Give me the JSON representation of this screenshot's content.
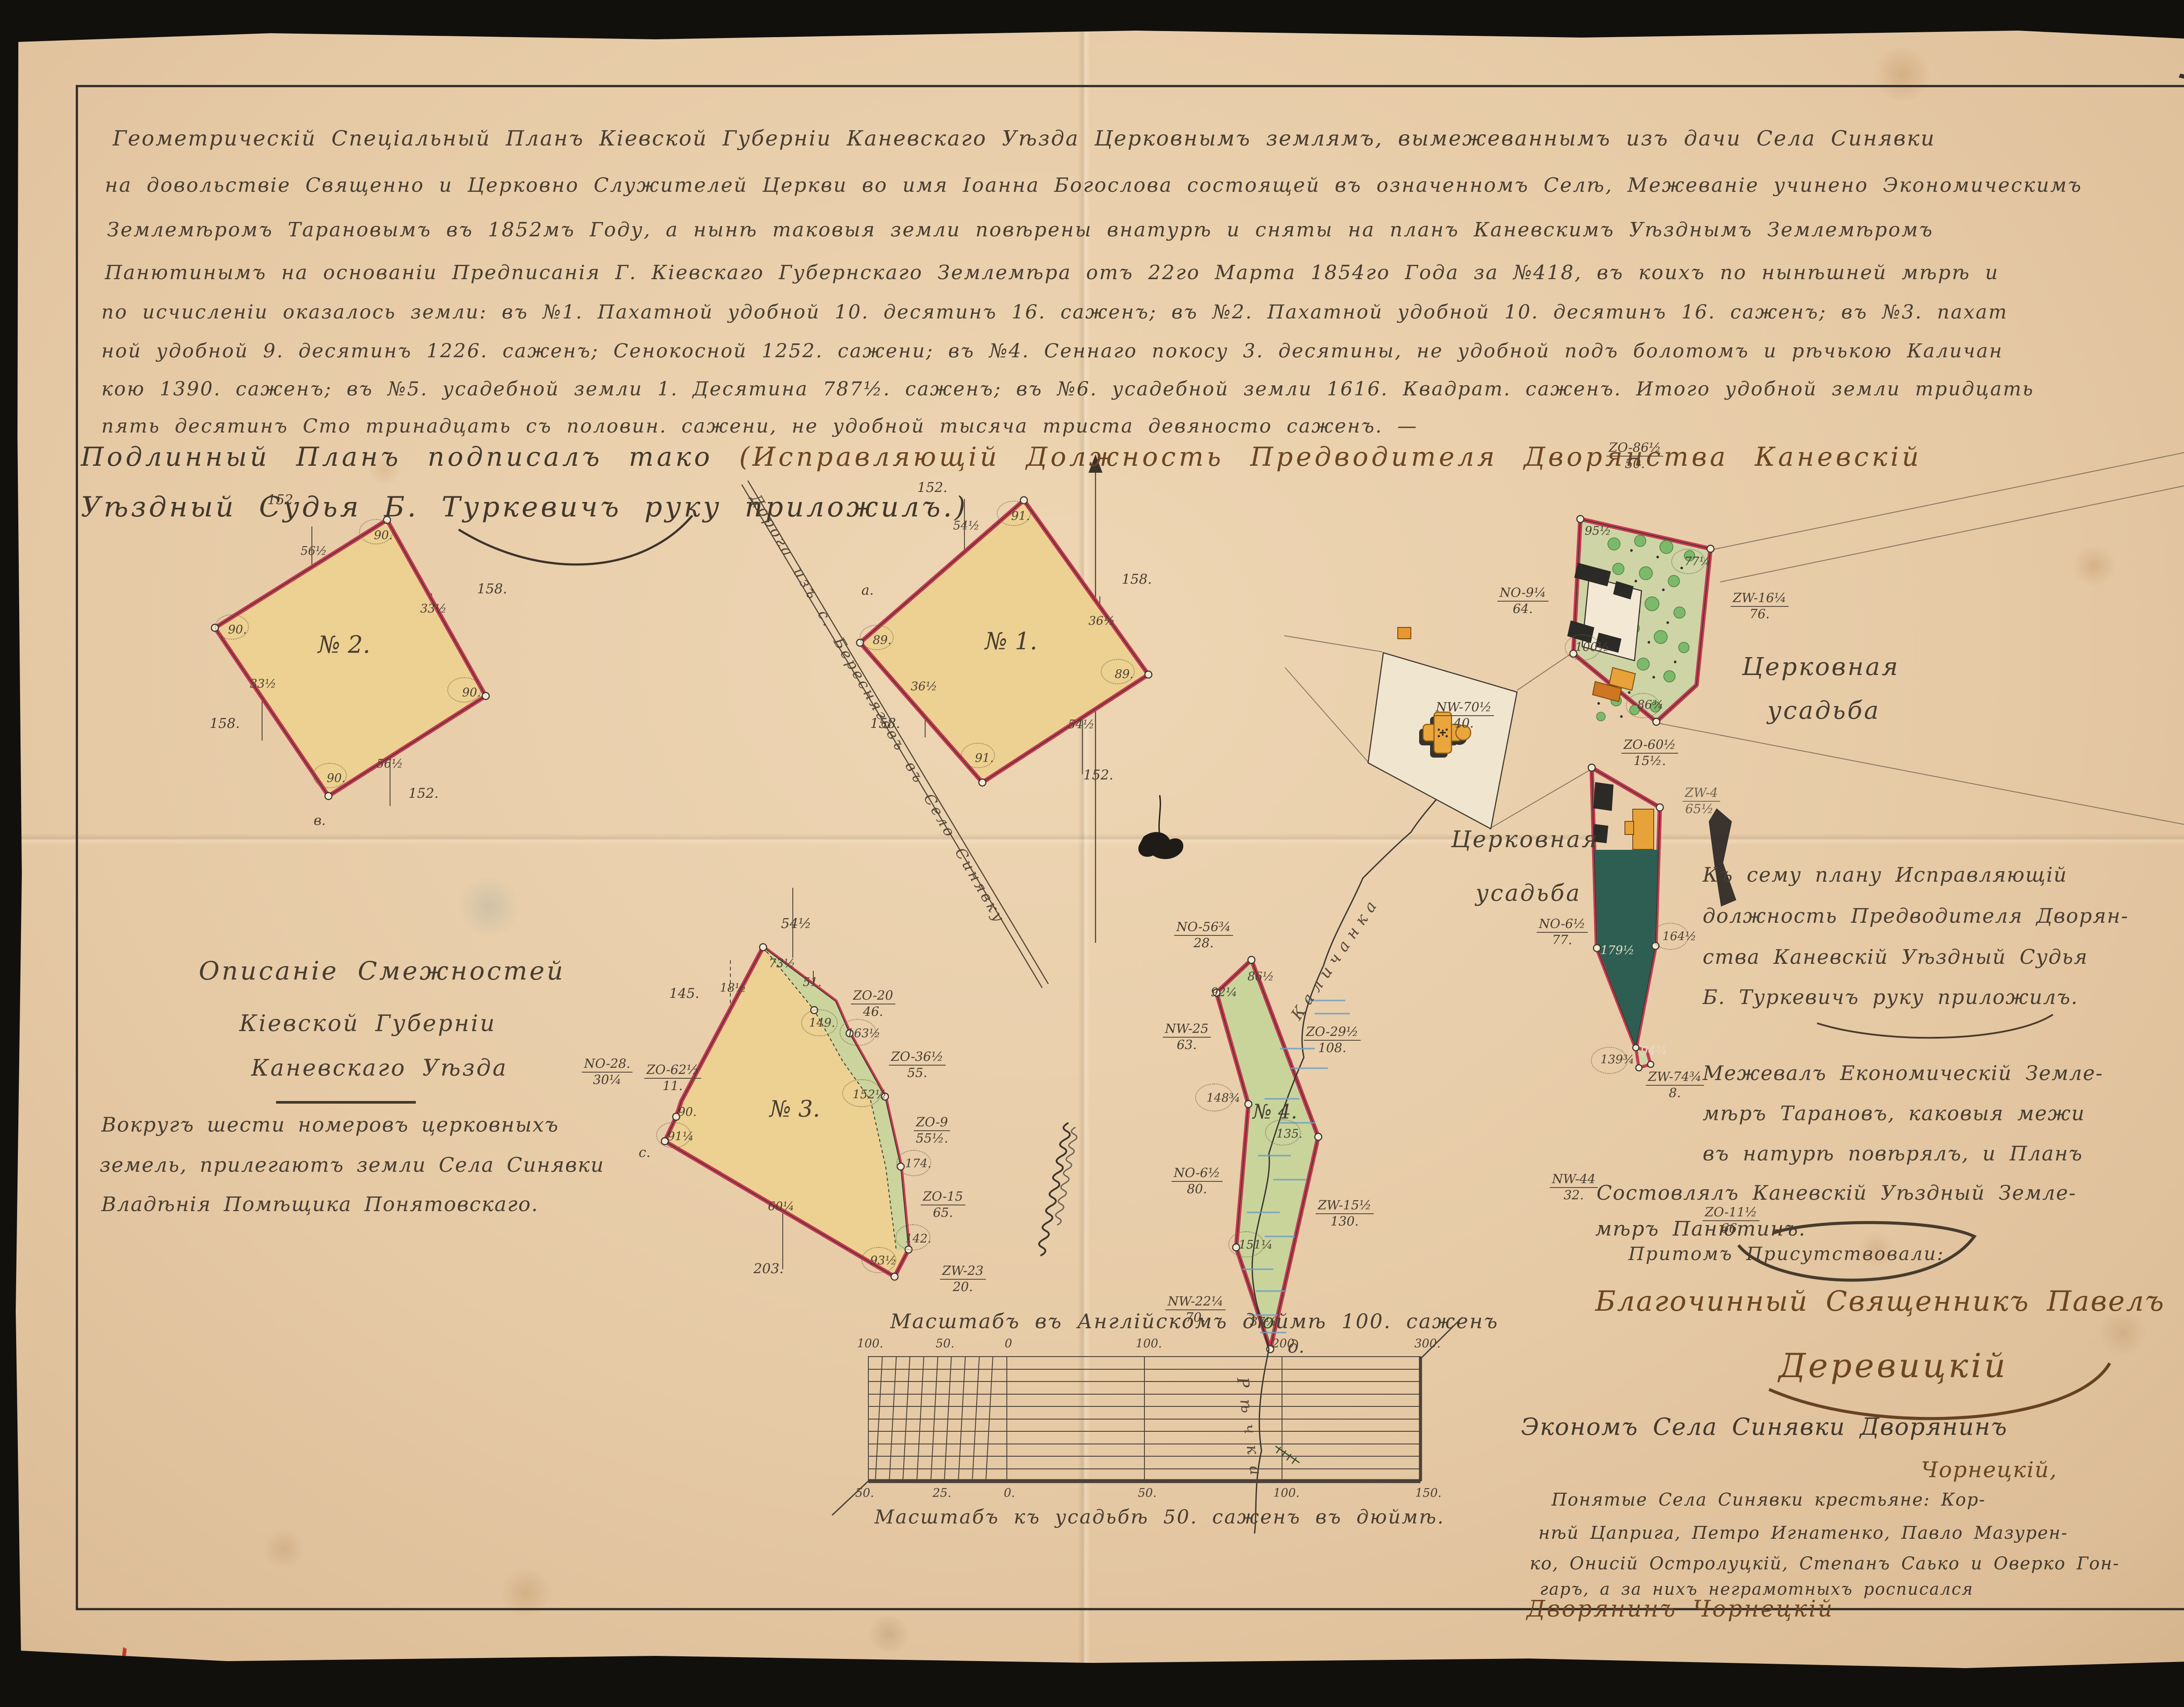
{
  "page_number": "1",
  "header": {
    "lines": [
      "Геометрическій Спеціальный Планъ Кіевской Губерніи Каневскаго Уѣзда Церковнымъ землямъ, вымежеваннымъ изъ дачи Села Синявки",
      "на довольствіе Священно и Церковно Служителей Церкви во имя Іоанна Богослова состоящей въ означенномъ Селѣ, Межеваніе учинено Экономическимъ",
      "Землемѣромъ Тарановымъ въ 1852мъ Году, а нынѣ таковыя земли повѣрены внатурѣ и сняты на планъ Каневскимъ Уѣзднымъ Землемѣромъ",
      "Панютинымъ на основаніи Предписанія Г. Кіевскаго Губернскаго Землемѣра отъ 22го Марта 1854го Года за №418, въ коихъ по нынѣшней мѣрѣ и",
      "по исчисленіи оказалось земли: въ №1. Пахатной удобной 10. десятинъ 16. саженъ; въ №2. Пахатной удобной 10. десятинъ 16. саженъ; въ №3. пахат",
      "ной удобной 9. десятинъ 1226. саженъ; Сенокосной 1252. сажени; въ №4. Сеннаго покосу 3. десятины, не удобной подъ болотомъ и рѣчькою Каличан",
      "кою 1390. саженъ; въ №5. усадебной земли 1. Десятина 787½. саженъ; въ №6. усадебной земли 1616. Квадрат. саженъ. Итого удобной земли тридцать",
      "пять десятинъ Сто тринадцать съ половин. сажени, не удобной тысяча триста девяносто саженъ. —"
    ]
  },
  "attestation": {
    "part1": "Подлинный Планъ подписалъ тако ",
    "part2": "(Исправляющій Должность Предводителя Дворянства Каневскій",
    "line2": "Уѣздный Судья Б. Туркевичъ руку приложилъ.)"
  },
  "plots": {
    "p1": {
      "no": "№ 1.",
      "s_top": "152.",
      "s_right": "158.",
      "s_left": "158.",
      "s_bottom": "152.",
      "b_top": "54½",
      "b_right": "36½",
      "b_left": "36½",
      "b_bottom": "54½",
      "a_top": "91.",
      "a_left": "89.",
      "a_right": "89.",
      "a_bottom": "91.",
      "pt": "а."
    },
    "p2": {
      "no": "№ 2.",
      "s_top": "152.",
      "s_right": "158.",
      "s_left": "158.",
      "s_bottom": "152.",
      "b_top": "56½",
      "b_right": "33½",
      "b_left": "33½",
      "b_bottom": "56½",
      "a_top": "90.",
      "a_left": "90.",
      "a_right": "90.",
      "a_bottom": "90.",
      "pt": "в."
    },
    "p3": {
      "no": "№ 3.",
      "s_top": "54½",
      "s_left": "145.",
      "s_bottom": "203.",
      "t18": "18½",
      "t51": "51.",
      "t60": "60¼",
      "a1": "73½",
      "a2": "149.",
      "a3": "163½",
      "a4": "152½",
      "a5": "174.",
      "a6": "142.",
      "a7": "93½",
      "a8": "91¼",
      "a9": "90.",
      "pt": "с."
    },
    "p4": {
      "no": "№ 4.",
      "a1": "92¼",
      "a2": "86½",
      "a3": "148¾",
      "a4": "135.",
      "a5": "151¼",
      "a6": "37¼",
      "pt": "д."
    },
    "church": {
      "a1": "95½",
      "a2": "77¼",
      "a3": "100½",
      "a4": "86¾"
    },
    "dark": {
      "a1": "179½",
      "a2": "164½",
      "a3": "139¾",
      "a4": "94¾"
    }
  },
  "bearings": [
    {
      "d": "ZO-86½",
      "s": "50."
    },
    {
      "d": "NO-9¼",
      "s": "64."
    },
    {
      "d": "ZW-16¼",
      "s": "76."
    },
    {
      "d": "NW-70½",
      "s": "40."
    },
    {
      "d": "ZO-60½",
      "s": "15½."
    },
    {
      "d": "NO-6½",
      "s": "77."
    },
    {
      "d": "ZW-4",
      "s": "65½."
    },
    {
      "d": "NW-44",
      "s": "32."
    },
    {
      "d": "ZO-11½",
      "s": "66."
    },
    {
      "d": "ZW-74¾",
      "s": "8."
    },
    {
      "d": "NO-56¾",
      "s": "28."
    },
    {
      "d": "NW-25",
      "s": "63."
    },
    {
      "d": "NO-6½",
      "s": "80."
    },
    {
      "d": "NW-22¼",
      "s": "70."
    },
    {
      "d": "ZO-29½",
      "s": "108."
    },
    {
      "d": "ZW-15½",
      "s": "130."
    },
    {
      "d": "ZO-20",
      "s": "46."
    },
    {
      "d": "ZO-36½",
      "s": "55."
    },
    {
      "d": "ZO-9",
      "s": "55½."
    },
    {
      "d": "ZO-15",
      "s": "65."
    },
    {
      "d": "ZW-23",
      "s": "20."
    },
    {
      "d": "ZO-62½",
      "s": "11."
    },
    {
      "d": "NO-28.",
      "s": "30¼"
    }
  ],
  "road_label": "Дорога изъ с. Бересняговъ въ Село Синявку",
  "river": {
    "top": "Каличанка",
    "bottom": "Рѣчка"
  },
  "estates": {
    "first": [
      "Церковная",
      "усадьба"
    ],
    "second": [
      "Церковная",
      "усадьба"
    ]
  },
  "adjacency": {
    "title": [
      "Описаніе Смежностей",
      "Кіевской Губерніи",
      "Каневскаго Уѣзда"
    ],
    "body": [
      "Вокругъ шести номеровъ церковныхъ",
      "земель, прилегаютъ земли Села Синявки",
      "Владѣнія Помѣщика Понятовскаго."
    ]
  },
  "survey_note": {
    "lines": [
      "Къ сему плану Исправляющій",
      "должность Предводителя Дворян-",
      "ства Каневскій Уѣздный Судья",
      "Б. Туркевичъ руку приложилъ.",
      "Межевалъ Економическій Земле-",
      "мѣръ Тарановъ, каковыя межи",
      "въ натурѣ повѣрялъ, и Планъ",
      "Состовлялъ Каневскій Уѣздный Земле-",
      "мѣръ Панютинъ."
    ]
  },
  "witnesses": {
    "header": "Притомъ Присутствовали:",
    "line1": "Благочинный Священникъ Павелъ",
    "line2": "Деревицкій",
    "line3": "Экономъ Села Синявки Дворянинъ",
    "line4": "Чорнецкій,",
    "line5": "Понятые Села Синявки крестьяне: Кор-",
    "line6": "нѣй Цаприга, Петро Игнатенко, Павло Мазурен-",
    "line7": "ко, Онисій Остролуцкій, Степанъ Саько и Оверко Гон-",
    "line8": "гаръ, а за нихъ неграмотныхъ росписался",
    "line9": "Дворянинъ Чорнецкій"
  },
  "scales": {
    "top_label": "Масштабъ въ Англійскомъ дюймѣ 100. саженъ",
    "top_ticks": [
      "100.",
      "50.",
      "0",
      "100.",
      "200.",
      "300."
    ],
    "bottom_ticks": [
      "50.",
      "25.",
      "0.",
      "50.",
      "100.",
      "150."
    ],
    "bottom_label": "Масштабъ къ усадьбѣ 50. саженъ въ дюймѣ."
  }
}
